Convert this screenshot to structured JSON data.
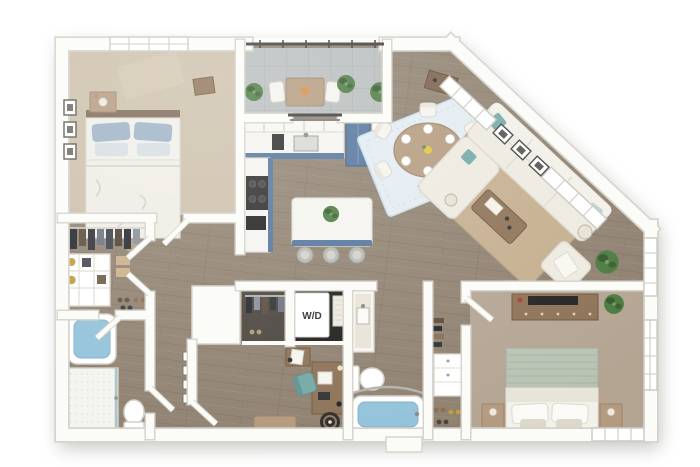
{
  "labels": {
    "washer_dryer": "W/D"
  },
  "palette": {
    "wall": "#fbfbf8",
    "wall_edge": "#d5d3cb",
    "wood": "#8f8170",
    "wood_dark": "#7b6e5e",
    "wood_hl": "#9c8e7c",
    "carpet_main": "#cdc0aa",
    "carpet_bed2": "#b4a593",
    "concrete": "#b9bdbd",
    "cabinet_blue": "#52749c",
    "counter": "#f5f4ef",
    "appliance_dark": "#2a2a2a",
    "tub_blue": "#92c2da",
    "sofa": "#edeae0",
    "rug_dining": "#e3ecf2",
    "rug_living": "#c8b190",
    "wood_furniture": "#8d7256",
    "wood_light": "#b49a7e",
    "plant": "#4a7a3f",
    "plant_dark": "#33582b",
    "teal": "#74a8a6",
    "rail": "#3c3c3c"
  },
  "plan": {
    "type": "3d-floor-plan-render",
    "rooms": [
      {
        "id": "bedroom-1",
        "name": "bedroom 1",
        "floor": "carpet",
        "items": [
          "queen bed with blue pillows",
          "nightstand with lamp",
          "three framed artworks",
          "round stool",
          "valet bench",
          "window"
        ]
      },
      {
        "id": "walk-in-closet-1",
        "name": "walk-in closet 1",
        "floor": "wood",
        "items": [
          "hanging clothes",
          "cubby shelving unit",
          "storage boxes",
          "shoes"
        ]
      },
      {
        "id": "bathroom-1",
        "name": "bathroom 1",
        "floor": "wood",
        "items": [
          "soaking tub",
          "walk-in shower with glass door",
          "toilet"
        ]
      },
      {
        "id": "hallway",
        "name": "hallway",
        "floor": "wood",
        "items": [
          "gallery wall frames"
        ]
      },
      {
        "id": "balcony",
        "name": "balcony",
        "floor": "concrete",
        "items": [
          "railing",
          "bistro table with fruit bowl",
          "two chairs",
          "potted plants"
        ]
      },
      {
        "id": "entry-nook",
        "name": "entry nook",
        "floor": "wood",
        "items": [
          "console table",
          "potted plants"
        ]
      },
      {
        "id": "kitchen",
        "name": "kitchen",
        "floor": "wood",
        "items": [
          "upper cabinets",
          "counter with sink",
          "coffee maker",
          "blue refrigerator",
          "pantry cabinet",
          "cooktop with oven",
          "island with plant",
          "three bar stools"
        ]
      },
      {
        "id": "dining-area",
        "name": "dining area",
        "floor": "wood",
        "items": [
          "oval table",
          "six chairs",
          "place settings",
          "yellow centerpiece",
          "patterned blue rug"
        ]
      },
      {
        "id": "living-room",
        "name": "living room",
        "floor": "wood",
        "items": [
          "white sectional sofa with chaise",
          "teal accent pillows",
          "coffee table with tray",
          "jute rug",
          "armchair",
          "two floor lamps",
          "tall potted plant",
          "three framed artworks",
          "angled window wall"
        ]
      },
      {
        "id": "den-office",
        "name": "den / office",
        "floor": "wood",
        "items": [
          "desk",
          "teal desk chair",
          "side table",
          "bench",
          "round pouf"
        ]
      },
      {
        "id": "laundry-closet",
        "name": "laundry closet",
        "floor": "wood",
        "items": [
          "stacked washer dryer",
          "hamper"
        ]
      },
      {
        "id": "coat-closet",
        "name": "coat closet",
        "floor": "wood",
        "items": [
          "hanging clothes",
          "shoes"
        ]
      },
      {
        "id": "bathroom-2",
        "name": "bathroom 2",
        "floor": "wood",
        "items": [
          "vanity with sink",
          "toilet",
          "tub with curtain rod"
        ]
      },
      {
        "id": "walk-in-closet-2",
        "name": "walk-in closet 2",
        "floor": "wood",
        "items": [
          "dresser",
          "hanging clothes",
          "shoes"
        ]
      },
      {
        "id": "bedroom-2",
        "name": "bedroom 2",
        "floor": "carpet",
        "items": [
          "queen bed with sage blanket",
          "two nightstands with lamps",
          "media console with tv",
          "potted plant",
          "two windows"
        ]
      }
    ]
  }
}
